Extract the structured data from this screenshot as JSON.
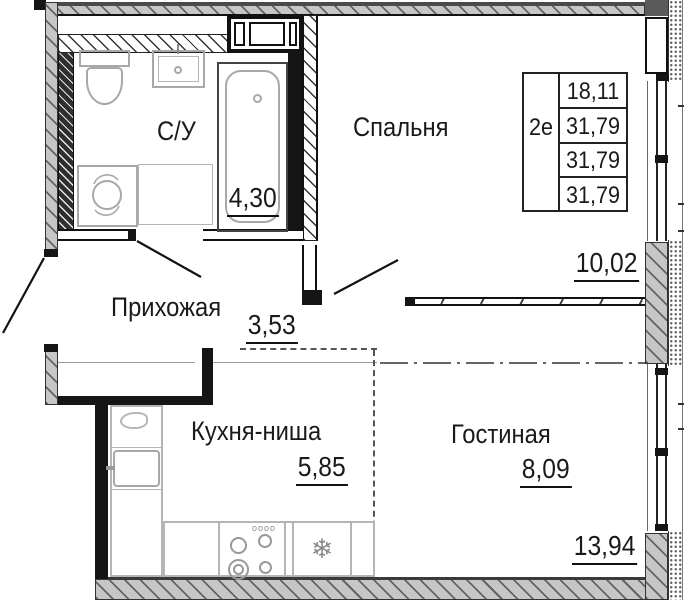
{
  "floor_plan": {
    "info_table": {
      "unit_type": "2е",
      "areas": [
        "18,11",
        "31,79",
        "31,79",
        "31,79"
      ]
    },
    "rooms": {
      "bathroom": {
        "name": "С/У",
        "area": "4,30"
      },
      "bedroom": {
        "name": "Спальня",
        "area": "10,02"
      },
      "hallway": {
        "name": "Прихожая",
        "area": "3,53"
      },
      "kitchen_niche": {
        "name": "Кухня-ниша",
        "area": "5,85"
      },
      "living_room": {
        "name": "Гостиная",
        "area": "8,09",
        "total_area": "13,94"
      }
    },
    "icons": {
      "stove_knobs": "oooo",
      "snowflake": "❄"
    },
    "colors": {
      "line": "#1a1a1a",
      "wall_gray": "#c6c6c6",
      "fixture_gray": "#a8a8a8"
    }
  }
}
